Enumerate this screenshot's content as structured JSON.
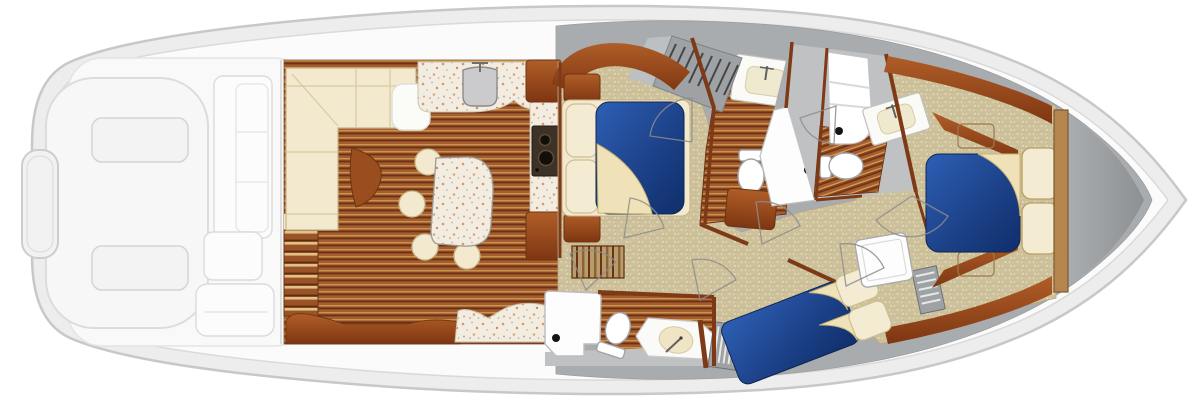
{
  "diagram": {
    "type": "yacht-interior-floor-plan",
    "orientation": "bow-right",
    "view": "overhead"
  },
  "colors": {
    "hull_fill": "#EDEDED",
    "hull_stroke": "#C8C8C8",
    "deck_fill": "#FBFBFB",
    "deck_stroke": "#DADADA",
    "cockpit_fill": "#F7F7F7",
    "cockpit_stroke": "#DEDEDE",
    "side_deck": "#A9ACAE",
    "head_floor_gray": "#BFC1C3",
    "stair_gray": "#9FA2A4",
    "stair_light": "#BDC0C2",
    "carpet_base": "#CDC19C",
    "carpet_dot": "#E6DBB6",
    "wood_mid": "#A65C2F",
    "wood_dark": "#6A3315",
    "wood_gold": "#D2A155",
    "cabinet": "#9A4E20",
    "cabinet_dark": "#6E3410",
    "bulkhead_tan": "#B5854F",
    "cream": "#F2E9CE",
    "cream_stroke": "#C5B488",
    "white": "#FFFFFF",
    "bed_blue": "#2B57A9",
    "bed_blue_deep": "#0F2E6B",
    "granite": "#F3EDE1",
    "fixture_stroke": "#A3A4A6",
    "drain": "#141414"
  },
  "legend": {
    "areas": [
      "cockpit",
      "salon",
      "galley",
      "dinette",
      "companionway",
      "mid-stateroom",
      "day-head",
      "shower",
      "master-head",
      "guest-stateroom",
      "guest-head",
      "master-stateroom",
      "bow-deck"
    ],
    "fixtures": [
      "double-berth",
      "pillows",
      "toilet",
      "vanity-sink",
      "shower-drain",
      "cooktop-burners",
      "dinette-table",
      "stools",
      "sofa",
      "stairs",
      "deck-hatches",
      "transom-door"
    ]
  }
}
